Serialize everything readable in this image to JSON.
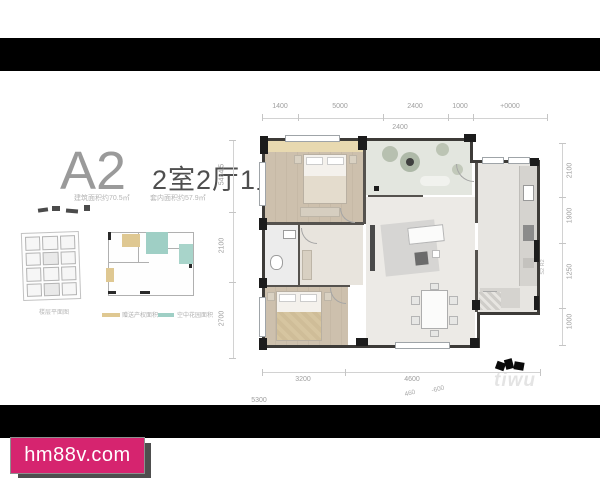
{
  "page": {
    "watermark_site": "hm88v.com",
    "watermark_plan": "tiwu",
    "colors": {
      "accent_pink": "#d6246f",
      "gift_tan": "#dfc892",
      "gift_teal": "#9fcfc5",
      "letterbox": "#000000"
    }
  },
  "unit": {
    "name": "A2",
    "layout": "2室2厅1卫",
    "building_area": "建筑面积约70.5㎡",
    "inner_area": "套内面积约57.9㎡"
  },
  "thumbnails": {
    "floorplate_caption": "楼层平面图",
    "legend": [
      {
        "label": "赠送产权面积",
        "color": "#dfc892"
      },
      {
        "label": "空中花园面积",
        "color": "#9fcfc5"
      }
    ]
  },
  "dims": {
    "top": [
      "1400",
      "5000",
      "2400",
      "1000",
      "+0000"
    ],
    "top_inner": "2400",
    "left": [
      "5484.5",
      "2100",
      "2700"
    ],
    "right": [
      "2100",
      "1900",
      "1250",
      "1000"
    ],
    "right_small": "S2 R2",
    "bottom": [
      "3200",
      "4600"
    ],
    "bottom_inner_a": "5300",
    "bottom_inner_b": "460",
    "bottom_inner_c": "-600"
  }
}
